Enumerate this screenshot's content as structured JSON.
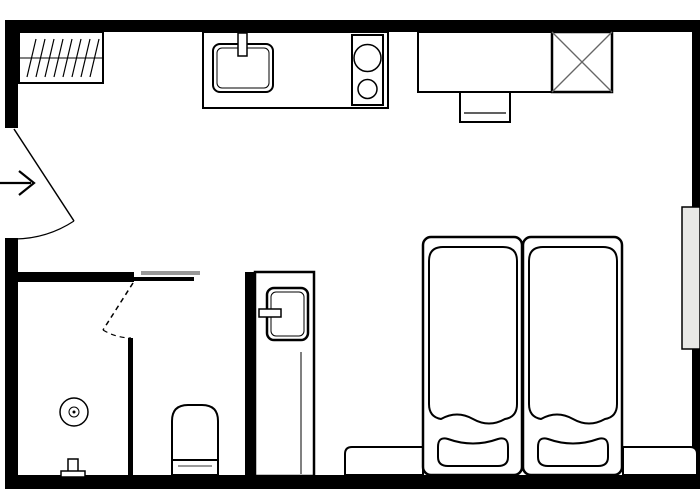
{
  "document": {
    "kind": "architectural-floor-plan",
    "visible_text": []
  },
  "canvas": {
    "width": 700,
    "height": 500,
    "background": "#ffffff"
  },
  "palette": {
    "wall": "#000000",
    "outline": "#000000",
    "window_fill": "#e8e8e6",
    "door_track_gray": "#999999",
    "shaft_diagonal": "#666666",
    "toilet_water_line": "#999999",
    "fill_white": "#ffffff"
  },
  "floorplan": {
    "elements": [
      {
        "name": "wall-top",
        "tag": "rect",
        "interactable": false,
        "attrs": {
          "x": 6,
          "y": 20,
          "width": 694,
          "height": 12,
          "fill": "#000000"
        }
      },
      {
        "name": "wall-left-upper",
        "tag": "rect",
        "interactable": false,
        "attrs": {
          "x": 5,
          "y": 20,
          "width": 13,
          "height": 108,
          "fill": "#000000"
        }
      },
      {
        "name": "wall-left-lower",
        "tag": "rect",
        "interactable": false,
        "attrs": {
          "x": 5,
          "y": 238,
          "width": 13,
          "height": 250,
          "fill": "#000000"
        }
      },
      {
        "name": "wall-bottom",
        "tag": "rect",
        "interactable": false,
        "attrs": {
          "x": 5,
          "y": 475,
          "width": 695,
          "height": 14,
          "fill": "#000000"
        }
      },
      {
        "name": "wall-right-upper",
        "tag": "rect",
        "interactable": false,
        "attrs": {
          "x": 692,
          "y": 20,
          "width": 8,
          "height": 187,
          "fill": "#000000"
        }
      },
      {
        "name": "wall-right-lower",
        "tag": "rect",
        "interactable": false,
        "attrs": {
          "x": 692,
          "y": 349,
          "width": 8,
          "height": 139,
          "fill": "#000000"
        }
      },
      {
        "name": "wall-bathroom-top",
        "tag": "rect",
        "interactable": false,
        "attrs": {
          "x": 5,
          "y": 272,
          "width": 129,
          "height": 10,
          "fill": "#000000"
        }
      },
      {
        "name": "wall-bathroom-top-thin",
        "tag": "rect",
        "interactable": false,
        "attrs": {
          "x": 134,
          "y": 277,
          "width": 60,
          "height": 4,
          "fill": "#000000"
        }
      },
      {
        "name": "pocket-door-track",
        "tag": "rect",
        "interactable": false,
        "attrs": {
          "x": 141,
          "y": 271,
          "width": 59,
          "height": 4,
          "fill": "#999999"
        }
      },
      {
        "name": "wall-bathroom-divider",
        "tag": "rect",
        "interactable": false,
        "attrs": {
          "x": 128,
          "y": 338,
          "width": 5,
          "height": 137,
          "fill": "#000000"
        }
      },
      {
        "name": "wall-cabinet-strip",
        "tag": "rect",
        "interactable": false,
        "attrs": {
          "x": 245,
          "y": 272,
          "width": 10,
          "height": 203,
          "fill": "#000000"
        }
      },
      {
        "name": "window-right",
        "tag": "rect",
        "interactable": false,
        "attrs": {
          "x": 682,
          "y": 207,
          "width": 18,
          "height": 142,
          "fill": "#e8e8e6",
          "stroke": "#000000",
          "stroke-width": 1.5
        }
      },
      {
        "name": "entry-door-leaf",
        "tag": "line",
        "interactable": false,
        "attrs": {
          "x1": 14,
          "y1": 129,
          "x2": 74,
          "y2": 221,
          "stroke": "#000000",
          "stroke-width": 1.5
        }
      },
      {
        "name": "entry-door-swing-arc",
        "tag": "path",
        "interactable": false,
        "attrs": {
          "d": "M74,221 A110,110 0 0 1 15,239",
          "fill": "none",
          "stroke": "#000000",
          "stroke-width": 1.2
        }
      },
      {
        "name": "entry-arrow-shaft",
        "tag": "line",
        "interactable": false,
        "attrs": {
          "x1": 0,
          "y1": 183,
          "x2": 31,
          "y2": 183,
          "stroke": "#000000",
          "stroke-width": 2.2
        }
      },
      {
        "name": "entry-arrow-head",
        "tag": "path",
        "interactable": false,
        "attrs": {
          "d": "M19,171 L34,183 L19,195",
          "fill": "none",
          "stroke": "#000000",
          "stroke-width": 2.2
        }
      },
      {
        "name": "bathroom-door-leaf-dashed",
        "tag": "line",
        "interactable": false,
        "attrs": {
          "x1": 133,
          "y1": 283,
          "x2": 103,
          "y2": 330,
          "stroke": "#000000",
          "stroke-width": 1.5,
          "stroke-dasharray": "5,4"
        }
      },
      {
        "name": "bathroom-door-swing-arc-dashed",
        "tag": "path",
        "interactable": false,
        "attrs": {
          "d": "M103,330 A55,55 0 0 0 131,338",
          "fill": "none",
          "stroke": "#000000",
          "stroke-width": 1.2,
          "stroke-dasharray": "5,4"
        }
      },
      {
        "name": "radiator-box",
        "tag": "rect",
        "interactable": false,
        "attrs": {
          "x": 19,
          "y": 32,
          "width": 84,
          "height": 51,
          "fill": "#ffffff",
          "stroke": "#000000",
          "stroke-width": 2
        }
      },
      {
        "name": "radiator-midline",
        "tag": "line",
        "interactable": false,
        "attrs": {
          "x1": 19,
          "y1": 58,
          "x2": 103,
          "y2": 58,
          "stroke": "#000000",
          "stroke-width": 1
        }
      },
      {
        "name": "radiator-hatching",
        "tag": "path",
        "interactable": false,
        "attrs": {
          "d": "M36,39 L27,77 M45,39 L36,77 M54,39 L45,77 M63,39 L54,77 M72,39 L63,77 M81,39 L72,77 M90,39 L81,77 M99,39 L90,77",
          "fill": "none",
          "stroke": "#000000",
          "stroke-width": 1.2
        }
      },
      {
        "name": "kitchen-counter",
        "tag": "rect",
        "interactable": false,
        "attrs": {
          "x": 203,
          "y": 32,
          "width": 185,
          "height": 76,
          "fill": "#ffffff",
          "stroke": "#000000",
          "stroke-width": 2
        }
      },
      {
        "name": "sink-basin-outer",
        "tag": "rect",
        "interactable": false,
        "attrs": {
          "x": 213,
          "y": 44,
          "width": 60,
          "height": 48,
          "rx": 7,
          "fill": "#ffffff",
          "stroke": "#000000",
          "stroke-width": 2
        }
      },
      {
        "name": "sink-basin-inner",
        "tag": "rect",
        "interactable": false,
        "attrs": {
          "x": 217,
          "y": 48,
          "width": 52,
          "height": 40,
          "rx": 5,
          "fill": "none",
          "stroke": "#000000",
          "stroke-width": 1
        }
      },
      {
        "name": "sink-faucet",
        "tag": "rect",
        "interactable": false,
        "attrs": {
          "x": 238,
          "y": 33,
          "width": 9,
          "height": 23,
          "fill": "#ffffff",
          "stroke": "#000000",
          "stroke-width": 1.5
        }
      },
      {
        "name": "stove-box",
        "tag": "rect",
        "interactable": false,
        "attrs": {
          "x": 352,
          "y": 35,
          "width": 31,
          "height": 70,
          "fill": "#ffffff",
          "stroke": "#000000",
          "stroke-width": 2
        }
      },
      {
        "name": "stove-burner-large",
        "tag": "circle",
        "interactable": false,
        "attrs": {
          "cx": 367.5,
          "cy": 58,
          "r": 13.5,
          "fill": "#ffffff",
          "stroke": "#000000",
          "stroke-width": 1.5
        }
      },
      {
        "name": "stove-burner-small",
        "tag": "circle",
        "interactable": false,
        "attrs": {
          "cx": 367.5,
          "cy": 89,
          "r": 9.5,
          "fill": "#ffffff",
          "stroke": "#000000",
          "stroke-width": 1.5
        }
      },
      {
        "name": "desk",
        "tag": "rect",
        "interactable": false,
        "attrs": {
          "x": 418,
          "y": 32,
          "width": 134,
          "height": 60,
          "fill": "#ffffff",
          "stroke": "#000000",
          "stroke-width": 2
        }
      },
      {
        "name": "desk-chair",
        "tag": "rect",
        "interactable": false,
        "attrs": {
          "x": 460,
          "y": 92,
          "width": 50,
          "height": 30,
          "fill": "#ffffff",
          "stroke": "#000000",
          "stroke-width": 2
        }
      },
      {
        "name": "desk-chair-line",
        "tag": "line",
        "interactable": false,
        "attrs": {
          "x1": 464,
          "y1": 113,
          "x2": 506,
          "y2": 113,
          "stroke": "#000000",
          "stroke-width": 1.2
        }
      },
      {
        "name": "shaft-box",
        "tag": "rect",
        "interactable": false,
        "attrs": {
          "x": 552,
          "y": 32,
          "width": 60,
          "height": 60,
          "fill": "#ffffff",
          "stroke": "#000000",
          "stroke-width": 2.5
        }
      },
      {
        "name": "shaft-diagonal-1",
        "tag": "line",
        "interactable": false,
        "attrs": {
          "x1": 552,
          "y1": 32,
          "x2": 612,
          "y2": 92,
          "stroke": "#666666",
          "stroke-width": 1.3
        }
      },
      {
        "name": "shaft-diagonal-2",
        "tag": "line",
        "interactable": false,
        "attrs": {
          "x1": 612,
          "y1": 32,
          "x2": 552,
          "y2": 92,
          "stroke": "#666666",
          "stroke-width": 1.3
        }
      },
      {
        "name": "floor-drain-outer",
        "tag": "circle",
        "interactable": false,
        "attrs": {
          "cx": 74,
          "cy": 412,
          "r": 14,
          "fill": "#ffffff",
          "stroke": "#000000",
          "stroke-width": 1.5
        }
      },
      {
        "name": "floor-drain-inner",
        "tag": "circle",
        "interactable": false,
        "attrs": {
          "cx": 74,
          "cy": 412,
          "r": 5,
          "fill": "#ffffff",
          "stroke": "#000000",
          "stroke-width": 1
        }
      },
      {
        "name": "floor-drain-dot",
        "tag": "circle",
        "interactable": false,
        "attrs": {
          "cx": 74,
          "cy": 412,
          "r": 1.5,
          "fill": "#000000"
        }
      },
      {
        "name": "shower-valve-stem",
        "tag": "rect",
        "interactable": false,
        "attrs": {
          "x": 68,
          "y": 459,
          "width": 10,
          "height": 13,
          "fill": "#ffffff",
          "stroke": "#000000",
          "stroke-width": 1.5
        }
      },
      {
        "name": "shower-valve-base",
        "tag": "rect",
        "interactable": false,
        "attrs": {
          "x": 61,
          "y": 471,
          "width": 24,
          "height": 6,
          "fill": "#ffffff",
          "stroke": "#000000",
          "stroke-width": 1.5
        }
      },
      {
        "name": "toilet-body",
        "tag": "path",
        "interactable": false,
        "attrs": {
          "d": "M172,475 L172,421 Q172,405 188,405 L202,405 Q218,405 218,421 L218,475 Z",
          "fill": "#ffffff",
          "stroke": "#000000",
          "stroke-width": 2
        }
      },
      {
        "name": "toilet-tank-line",
        "tag": "line",
        "interactable": false,
        "attrs": {
          "x1": 172,
          "y1": 460,
          "x2": 218,
          "y2": 460,
          "stroke": "#000000",
          "stroke-width": 2
        }
      },
      {
        "name": "toilet-water-line",
        "tag": "line",
        "interactable": false,
        "attrs": {
          "x1": 178,
          "y1": 466,
          "x2": 212,
          "y2": 466,
          "stroke": "#999999",
          "stroke-width": 2
        }
      },
      {
        "name": "utility-cabinet",
        "tag": "rect",
        "interactable": false,
        "attrs": {
          "x": 255,
          "y": 272,
          "width": 59,
          "height": 204,
          "fill": "#ffffff",
          "stroke": "#000000",
          "stroke-width": 2.5
        }
      },
      {
        "name": "utility-cabinet-divider",
        "tag": "line",
        "interactable": false,
        "attrs": {
          "x1": 301,
          "y1": 352,
          "x2": 301,
          "y2": 474,
          "stroke": "#000000",
          "stroke-width": 1
        }
      },
      {
        "name": "boiler-door-outer",
        "tag": "rect",
        "interactable": false,
        "attrs": {
          "x": 267,
          "y": 288,
          "width": 41,
          "height": 52,
          "rx": 7,
          "fill": "#ffffff",
          "stroke": "#000000",
          "stroke-width": 2.5
        }
      },
      {
        "name": "boiler-door-inner",
        "tag": "rect",
        "interactable": false,
        "attrs": {
          "x": 271,
          "y": 292,
          "width": 33,
          "height": 44,
          "rx": 5,
          "fill": "none",
          "stroke": "#000000",
          "stroke-width": 1
        }
      },
      {
        "name": "boiler-door-handle",
        "tag": "rect",
        "interactable": false,
        "attrs": {
          "x": 259,
          "y": 309,
          "width": 22,
          "height": 8,
          "fill": "#ffffff",
          "stroke": "#000000",
          "stroke-width": 1.5
        }
      },
      {
        "name": "bench-left-of-beds",
        "tag": "path",
        "interactable": false,
        "attrs": {
          "d": "M345,475 L345,454 Q345,447 352,447 L423,447 L423,475 Z",
          "fill": "#ffffff",
          "stroke": "#000000",
          "stroke-width": 2
        }
      },
      {
        "name": "bench-right-of-beds",
        "tag": "path",
        "interactable": false,
        "attrs": {
          "d": "M623,475 L623,447 L690,447 Q697,447 697,454 L697,475 Z",
          "fill": "#ffffff",
          "stroke": "#000000",
          "stroke-width": 2
        }
      },
      {
        "name": "bed-left-frame",
        "tag": "rect",
        "interactable": false,
        "attrs": {
          "x": 423,
          "y": 237,
          "width": 99,
          "height": 238,
          "rx": 8,
          "fill": "#ffffff",
          "stroke": "#000000",
          "stroke-width": 2.5
        }
      },
      {
        "name": "bed-left-mattress",
        "tag": "path",
        "interactable": false,
        "attrs": {
          "d": "M429,261 L429,404 Q429,417 441,419 Q457,410 473,419 Q489,428 505,419 Q517,417 517,404 L517,261 Q517,247 503,247 L443,247 Q429,247 429,261 Z",
          "fill": "#ffffff",
          "stroke": "#000000",
          "stroke-width": 2
        }
      },
      {
        "name": "bed-left-pillow",
        "tag": "path",
        "interactable": false,
        "attrs": {
          "d": "M438,447 Q438,436 448,439 Q473,448 498,439 Q508,436 508,447 L508,457 Q508,466 498,466 L448,466 Q438,466 438,457 Z",
          "fill": "#ffffff",
          "stroke": "#000000",
          "stroke-width": 2
        }
      },
      {
        "name": "bed-right-frame",
        "tag": "rect",
        "interactable": false,
        "attrs": {
          "x": 523,
          "y": 237,
          "width": 99,
          "height": 238,
          "rx": 8,
          "fill": "#ffffff",
          "stroke": "#000000",
          "stroke-width": 2.5
        }
      },
      {
        "name": "bed-right-mattress",
        "tag": "path",
        "interactable": false,
        "attrs": {
          "d": "M529,261 L529,404 Q529,417 541,419 Q557,410 573,419 Q589,428 605,419 Q617,417 617,404 L617,261 Q617,247 603,247 L543,247 Q529,247 529,261 Z",
          "fill": "#ffffff",
          "stroke": "#000000",
          "stroke-width": 2
        }
      },
      {
        "name": "bed-right-pillow",
        "tag": "path",
        "interactable": false,
        "attrs": {
          "d": "M538,447 Q538,436 548,439 Q573,448 598,439 Q608,436 608,447 L608,457 Q608,466 598,466 L548,466 Q538,466 538,457 Z",
          "fill": "#ffffff",
          "stroke": "#000000",
          "stroke-width": 2
        }
      }
    ]
  }
}
